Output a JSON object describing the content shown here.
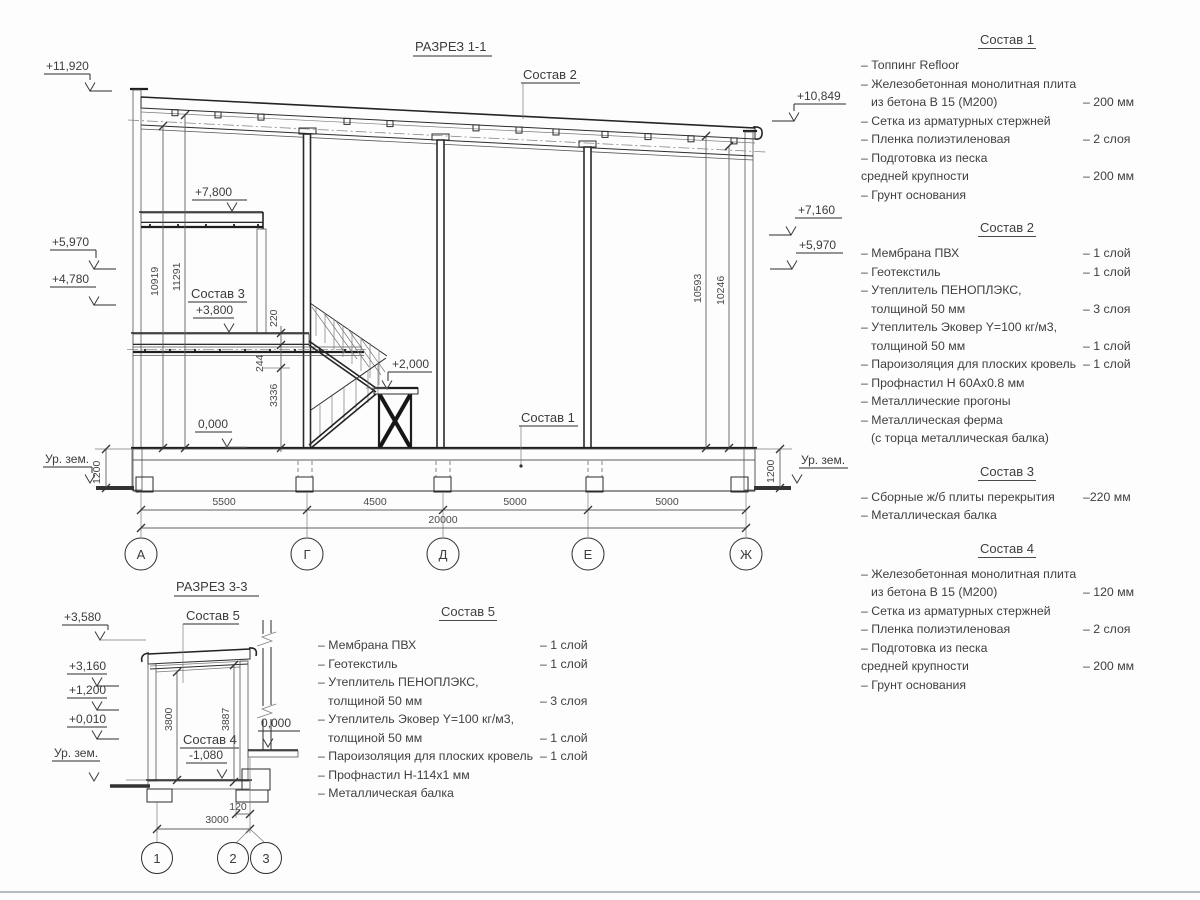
{
  "s11": {
    "title": "РАЗРЕЗ 1-1",
    "c1": "Состав 1",
    "c2": "Состав 2",
    "c3": "Состав 3",
    "e11920": "+11,920",
    "e5970l": "+5,970",
    "e4780": "+4,780",
    "e10849": "+10,849",
    "e7160": "+7,160",
    "e5970r": "+5,970",
    "e7800": "+7,800",
    "e3800": "+3,800",
    "e2000": "+2,000",
    "e0": "0,000",
    "gndl": "Ур. зем.",
    "gndr": "Ур. зем.",
    "d10919": "10919",
    "d11291": "11291",
    "d220": "220",
    "d244": "244",
    "d3336": "3336",
    "d10593": "10593",
    "d10246": "10246",
    "d1200l": "1200",
    "d1200r": "1200",
    "d5500": "5500",
    "d4500": "4500",
    "d5000a": "5000",
    "d5000b": "5000",
    "d20000": "20000",
    "axA": "А",
    "axG": "Г",
    "axD": "Д",
    "axE": "Е",
    "axZh": "Ж"
  },
  "s33": {
    "title": "РАЗРЕЗ 3-3",
    "c5": "Состав 5",
    "c4": "Состав 4",
    "e3580": "+3,580",
    "e3160": "+3,160",
    "e1200": "+1,200",
    "e0010": "+0,010",
    "e0": "0,000",
    "em1080": "-1,080",
    "gnd": "Ур. зем.",
    "d3800": "3800",
    "d3887": "3887",
    "d120": "120",
    "d3000": "3000",
    "ax1": "1",
    "ax2": "2",
    "ax3": "3"
  },
  "specs": {
    "s5": {
      "title": "Состав 5",
      "items": [
        {
          "t": "– Мембрана ПВХ",
          "v": "– 1 слой"
        },
        {
          "t": "– Геотекстиль",
          "v": "– 1 слой"
        },
        {
          "t": "– Утеплитель ПЕНОПЛЭКС,"
        },
        {
          "t": "толщиной 50 мм",
          "v": "– 3 слоя"
        },
        {
          "t": "– Утеплитель Эковер Y=100 кг/м3,"
        },
        {
          "t": "толщиной 50 мм",
          "v": "– 1 слой"
        },
        {
          "t": "– Пароизоляция для плоских кровель",
          "v": "– 1 слой"
        },
        {
          "t": "– Профнастил Н-114х1 мм"
        },
        {
          "t": "– Металлическая балка"
        }
      ]
    },
    "right": [
      {
        "title": "Состав 1",
        "items": [
          {
            "t": "– Топпинг Refloor"
          },
          {
            "t": "– Железобетонная  монолитная плита"
          },
          {
            "t": "из бетона В 15 (М200)",
            "v": "– 200 мм"
          },
          {
            "t": "– Сетка из арматурных стержней"
          },
          {
            "t": "– Пленка полиэтиленовая",
            "v": "– 2 слоя"
          },
          {
            "t": "– Подготовка из песка"
          },
          {
            "t": "средней крупности",
            "v": "– 200 мм"
          },
          {
            "t": "– Грунт основания"
          }
        ]
      },
      {
        "title": "Состав 2",
        "items": [
          {
            "t": "– Мембрана ПВХ",
            "v": "– 1 слой"
          },
          {
            "t": "– Геотекстиль",
            "v": "– 1 слой"
          },
          {
            "t": "– Утеплитель ПЕНОПЛЭКС,"
          },
          {
            "t": "толщиной 50 мм",
            "v": "– 3 слоя"
          },
          {
            "t": "– Утеплитель Эковер Y=100 кг/м3,"
          },
          {
            "t": "толщиной 50 мм",
            "v": "– 1 слой"
          },
          {
            "t": "– Пароизоляция для плоских кровель",
            "v": "– 1 слой"
          },
          {
            "t": "– Профнастил Н 60Ах0.8 мм"
          },
          {
            "t": "– Металлические прогоны"
          },
          {
            "t": "– Металлическая ферма"
          },
          {
            "t": "(с торца металлическая балка)"
          }
        ]
      },
      {
        "title": "Состав 3",
        "items": [
          {
            "t": "– Сборные ж/б плиты перекрытия",
            "v": "–220 мм"
          },
          {
            "t": "– Металлическая балка"
          }
        ]
      },
      {
        "title": "Состав 4",
        "items": [
          {
            "t": "– Железобетонная  монолитная плита"
          },
          {
            "t": "из бетона В 15 (М200)",
            "v": "– 120 мм"
          },
          {
            "t": "– Сетка из арматурных стержней"
          },
          {
            "t": "– Пленка полиэтиленовая",
            "v": "– 2 слоя"
          },
          {
            "t": "– Подготовка из песка"
          },
          {
            "t": "средней крупности",
            "v": "– 200 мм"
          },
          {
            "t": "– Грунт основания"
          }
        ]
      }
    ]
  }
}
